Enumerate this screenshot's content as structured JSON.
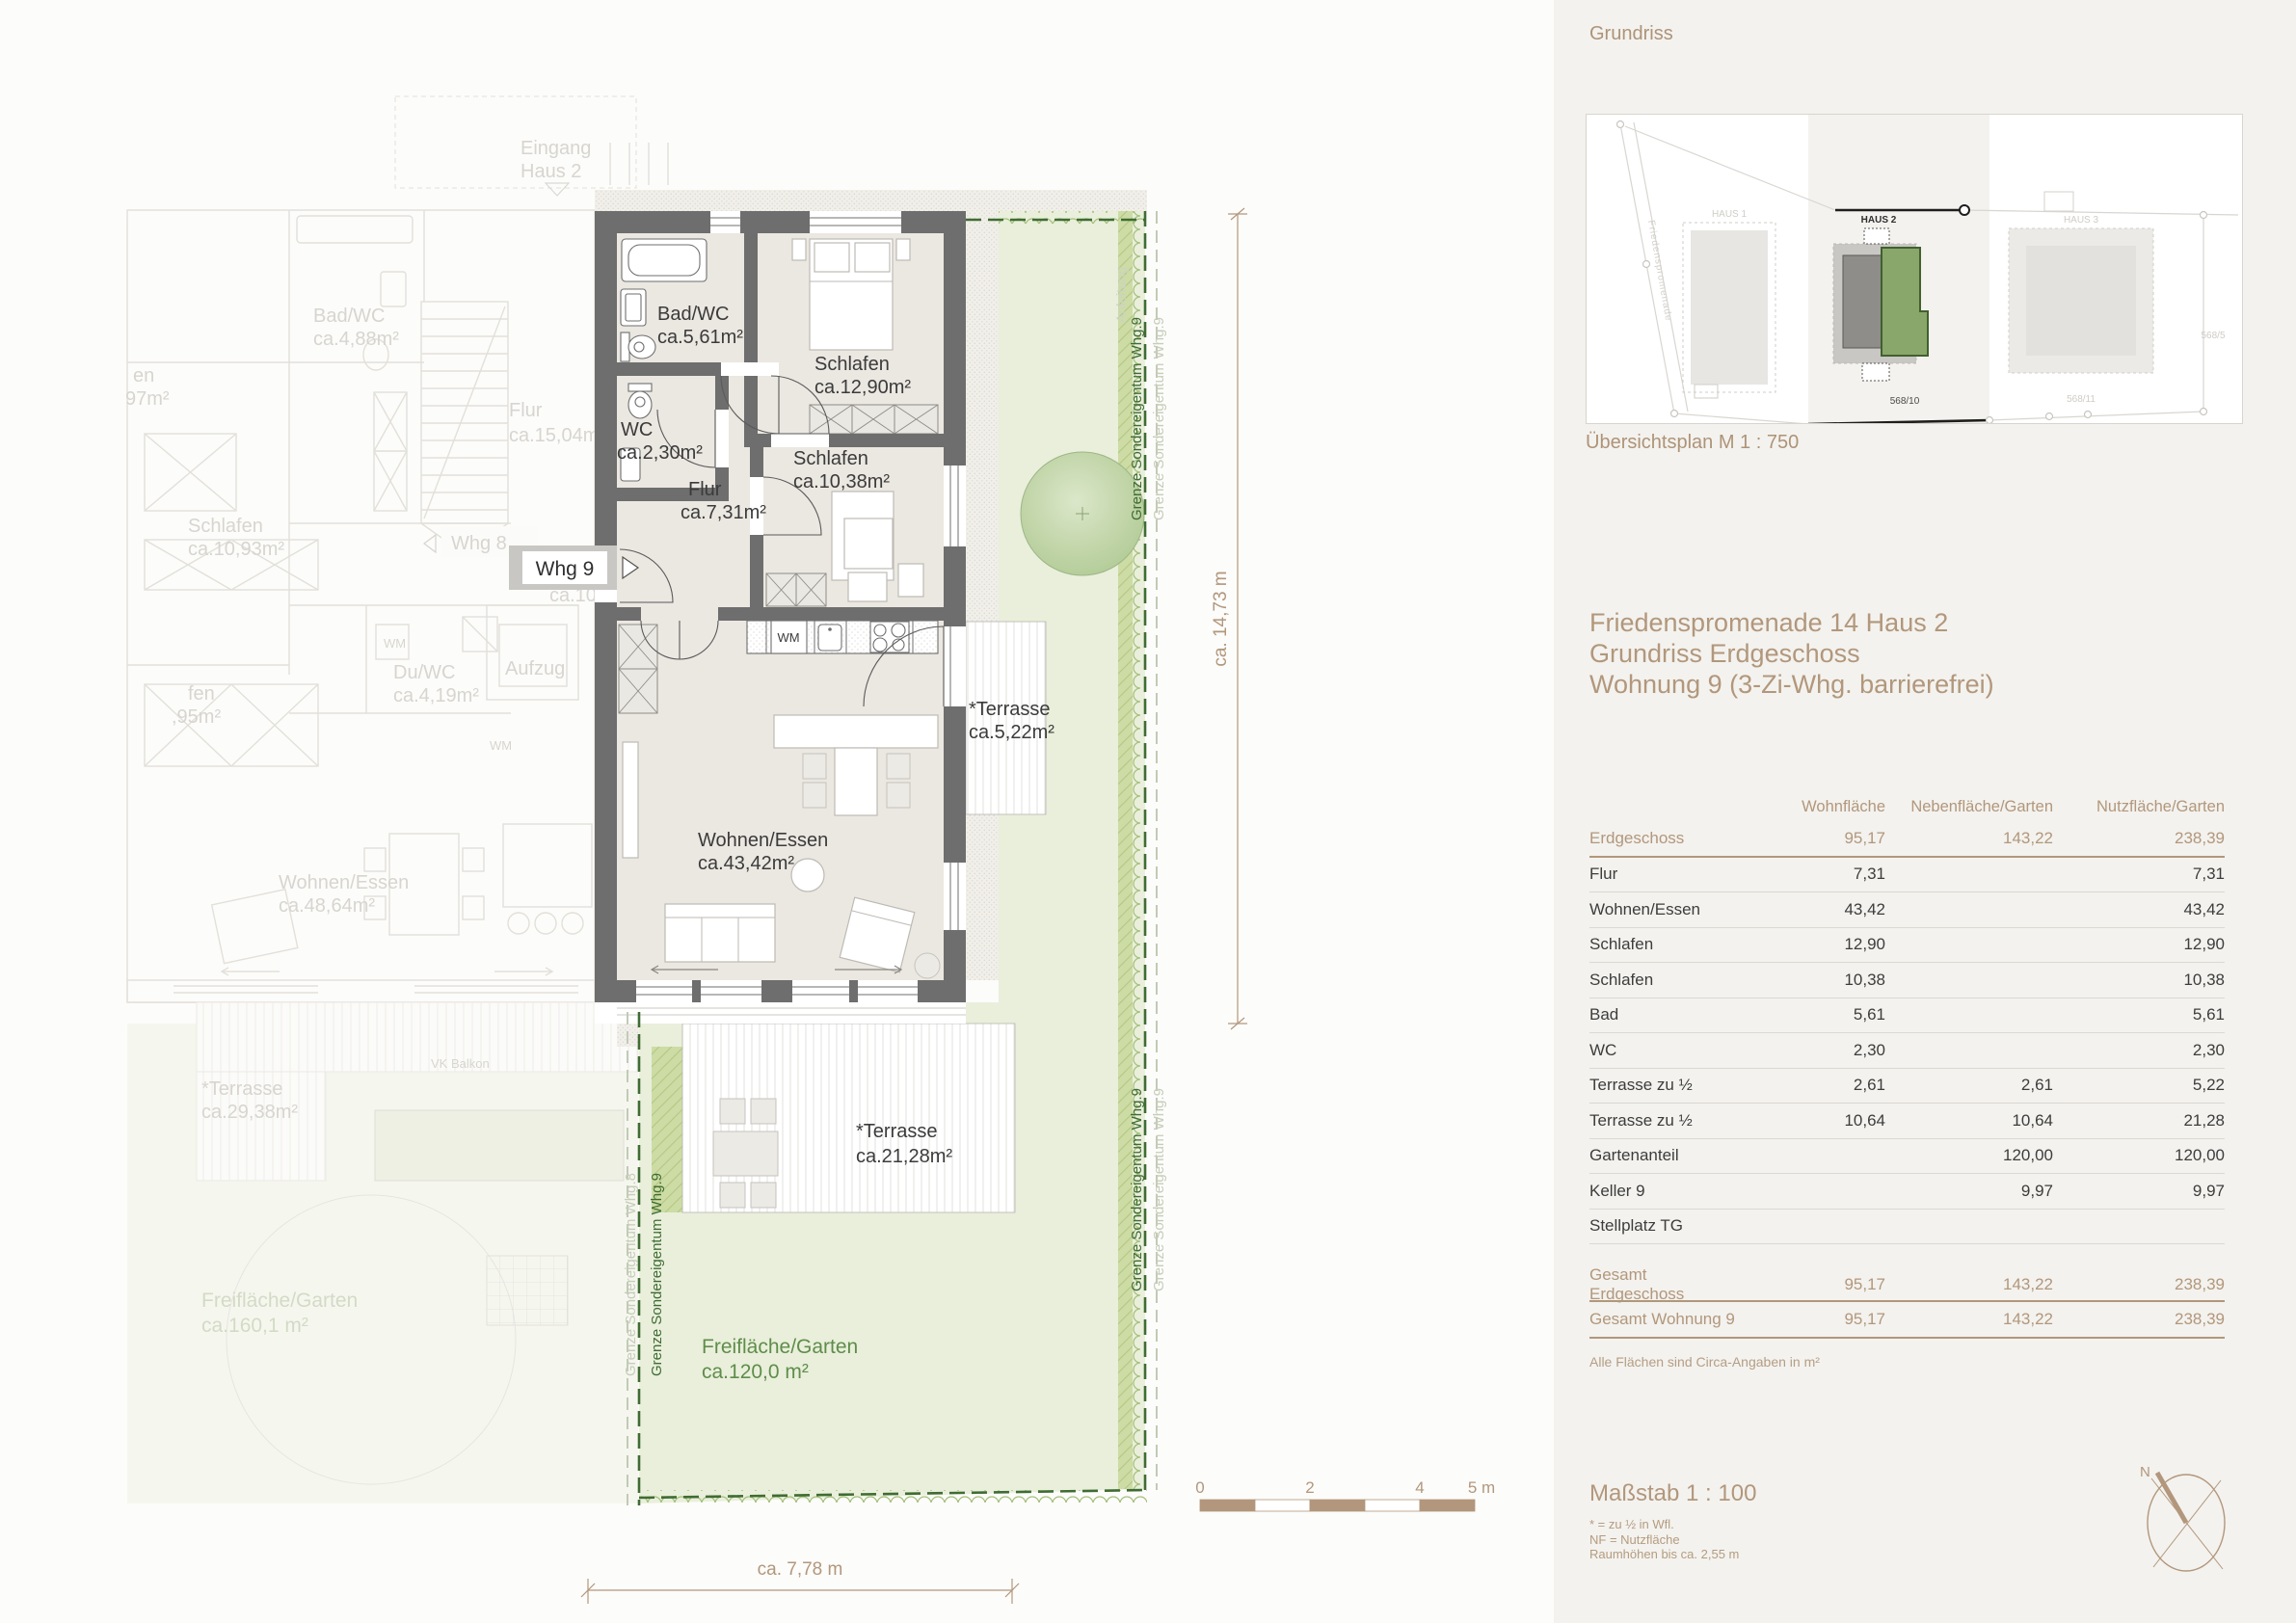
{
  "colors": {
    "accent": "#b2977c",
    "boundary_green": "#3f6c33",
    "garden_green": "#e9efdb",
    "wall_gray": "#6e6e6e"
  },
  "plan": {
    "badge": {
      "label": "Whg 9"
    },
    "rooms": {
      "bad": {
        "name": "Bad/WC",
        "area": "ca.5,61m²"
      },
      "wc": {
        "name": "WC",
        "area": "ca.2,30m²"
      },
      "flur": {
        "name": "Flur",
        "area": "ca.7,31m²"
      },
      "schlafen1": {
        "name": "Schlafen",
        "area": "ca.12,90m²"
      },
      "schlafen2": {
        "name": "Schlafen",
        "area": "ca.10,38m²"
      },
      "wohnen": {
        "name": "Wohnen/Essen",
        "area": "ca.43,42m²"
      },
      "terrasse_klein": {
        "name": "*Terrasse",
        "area": "ca.5,22m²"
      },
      "terrasse_gross": {
        "name": "*Terrasse",
        "area": "ca.21,28m²"
      },
      "garten": {
        "name": "Freifläche/Garten",
        "area": "ca.120,0 m²"
      },
      "wm": "WM"
    },
    "neighbor": {
      "eingang1": "Eingang",
      "eingang2": "Haus 2",
      "whg8": "Whg 8",
      "bad": {
        "name": "Bad/WC",
        "area": "ca.4,88m²"
      },
      "flur_main": {
        "name": "Flur",
        "area": "ca.15,04m²"
      },
      "schlafen": {
        "name": "Schlafen",
        "area": "ca.10,93m²"
      },
      "flur2": {
        "name": "Flur",
        "area": "ca.10,63m²"
      },
      "duwc": {
        "name": "Du/WC",
        "area": "ca.4,19m²"
      },
      "aufzug": "Aufzug",
      "wm1": "WM",
      "wm2": "WM",
      "wohnen": {
        "name": "Wohnen/Essen",
        "area": "ca.48,64m²"
      },
      "terrasse": {
        "name": "*Terrasse",
        "area": "ca.29,38m²"
      },
      "garten": {
        "name": "Freifläche/Garten",
        "area": "ca.160,1 m²"
      },
      "frag1a": "en",
      "frag1b": "97m²",
      "frag2a": "fen",
      "frag2b": ",95m²",
      "vk_balkon": "VK Balkon"
    },
    "boundaries": {
      "whg9": "Grenze Sondereigentum Whg.9",
      "whg8": "Grenze Sondereigentum Whg.8",
      "faint_note": "Anleitung"
    },
    "dimensions": {
      "vertical": "ca. 14,73 m",
      "horizontal": "ca. 7,78 m"
    },
    "scalebar": {
      "t0": "0",
      "t2": "2",
      "t4": "4",
      "t5": "5 m"
    }
  },
  "panel": {
    "title": "Grundriss",
    "overview_caption": "Übersichtsplan M 1 : 750",
    "overview": {
      "haus1": "HAUS 1",
      "haus2": "HAUS 2",
      "haus3": "HAUS 3",
      "p1": "568/10",
      "p2": "568/11",
      "p3": "568/5",
      "street": "Friedenspromenade"
    },
    "heading1": "Friedenspromenade 14 Haus 2",
    "heading2": "Grundriss Erdgeschoss",
    "heading3": "Wohnung 9 (3-Zi-Whg. barrierefrei)",
    "table": {
      "headers": [
        "Wohnfläche",
        "Nebenfläche/Garten",
        "Nutzfläche/Garten"
      ],
      "section": {
        "label": "Erdgeschoss",
        "c1": "95,17",
        "c2": "143,22",
        "c3": "238,39"
      },
      "rows": [
        {
          "label": "Flur",
          "c1": "7,31",
          "c2": "",
          "c3": "7,31"
        },
        {
          "label": "Wohnen/Essen",
          "c1": "43,42",
          "c2": "",
          "c3": "43,42"
        },
        {
          "label": "Schlafen",
          "c1": "12,90",
          "c2": "",
          "c3": "12,90"
        },
        {
          "label": "Schlafen",
          "c1": "10,38",
          "c2": "",
          "c3": "10,38"
        },
        {
          "label": "Bad",
          "c1": "5,61",
          "c2": "",
          "c3": "5,61"
        },
        {
          "label": "WC",
          "c1": "2,30",
          "c2": "",
          "c3": "2,30"
        },
        {
          "label": "Terrasse zu ½",
          "c1": "2,61",
          "c2": "2,61",
          "c3": "5,22"
        },
        {
          "label": "Terrasse zu ½",
          "c1": "10,64",
          "c2": "10,64",
          "c3": "21,28"
        },
        {
          "label": "Gartenanteil",
          "c1": "",
          "c2": "120,00",
          "c3": "120,00"
        },
        {
          "label": "Keller 9",
          "c1": "",
          "c2": "9,97",
          "c3": "9,97"
        },
        {
          "label": "Stellplatz TG",
          "c1": "",
          "c2": "",
          "c3": ""
        }
      ],
      "totals": [
        {
          "label": "Gesamt Erdgeschoss",
          "c1": "95,17",
          "c2": "143,22",
          "c3": "238,39"
        },
        {
          "label": "Gesamt Wohnung 9",
          "c1": "95,17",
          "c2": "143,22",
          "c3": "238,39"
        }
      ]
    },
    "footnote": "Alle Flächen sind Circa-Angaben in m²",
    "scale_title": "Maßstab 1 : 100",
    "note1": "* = zu ½ in Wfl.",
    "note2": "NF = Nutzfläche",
    "note3": "Raumhöhen bis ca. 2,55 m",
    "compass_n": "N"
  }
}
